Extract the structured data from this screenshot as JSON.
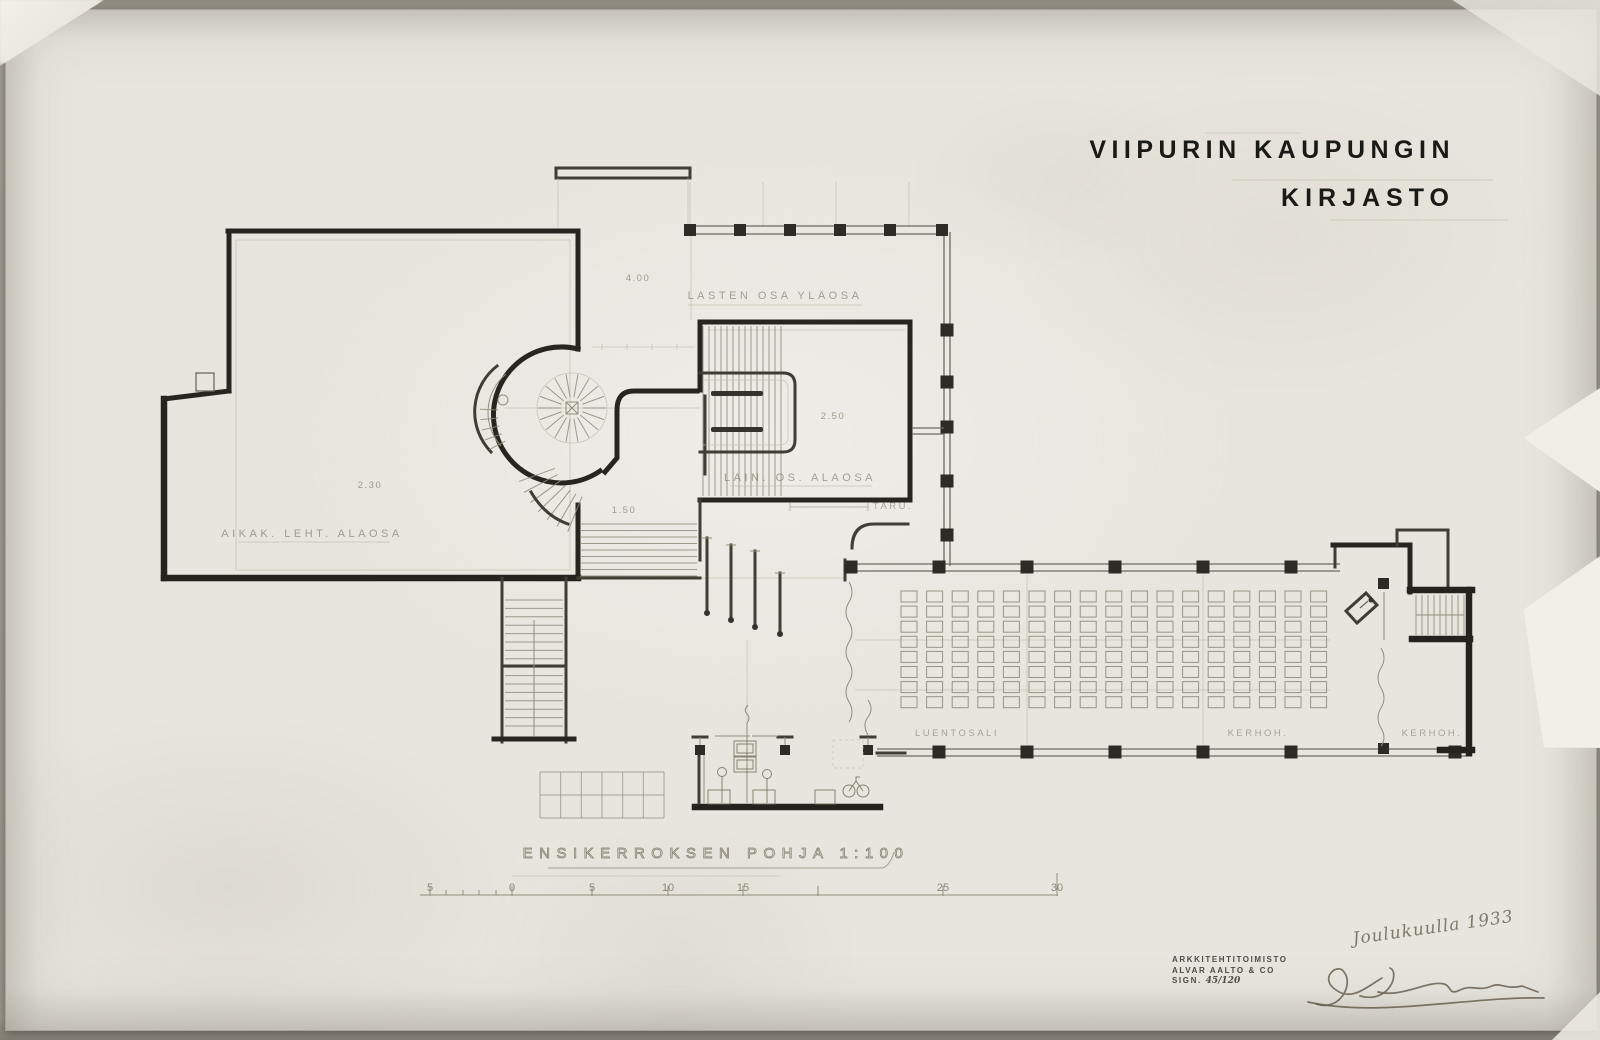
{
  "drawing": {
    "title_line1": "VIIPURIN KAUPUNGIN",
    "title_line2": "KIRJASTO",
    "caption": "ENSIKERROKSEN POHJA 1:100"
  },
  "room_labels": {
    "children_upper": "LASTEN OSA YLÄOSA",
    "periodicals_lower": "AIKAK. LEHT. ALAOSA",
    "lending_lower": "LAIN. OS. ALAOSA",
    "taru": "TARU.",
    "lecture_hall": "LUENTOSALI",
    "club_room_1": "KERHOH.",
    "club_room_2": "KERHOH."
  },
  "dimensions": {
    "d1": "4.00",
    "d2": "2.30",
    "d3": "2.50",
    "d4": "1.50"
  },
  "scale_bar": {
    "labels": [
      "5",
      "0",
      "5",
      "10",
      "15",
      "25",
      "30"
    ]
  },
  "stamp": {
    "office_line1": "ARKKITEHTITOIMISTO",
    "office_line2": "ALVAR AALTO & CO",
    "sign_label": "SIGN.",
    "sign_value": "45/120"
  },
  "handwriting": {
    "date_note": "Joulukuulla 1933"
  },
  "lecture_hall_seating": {
    "rows": 8,
    "cols": 17
  },
  "colors": {
    "paper": "#e8e5de",
    "ink": "#26251f",
    "pencil": "#938d7c"
  }
}
